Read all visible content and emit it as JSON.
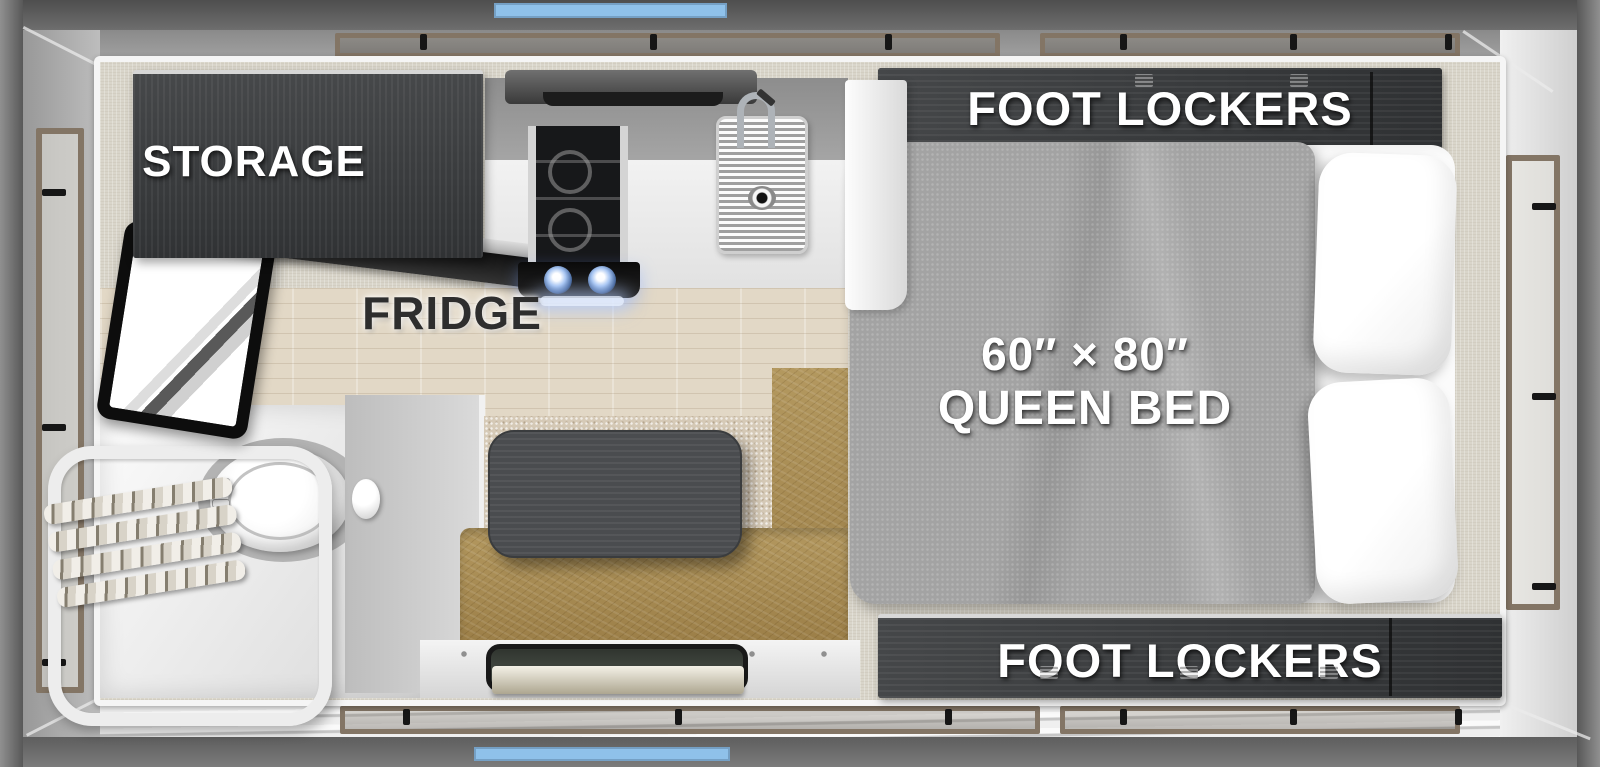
{
  "title": "Truck camper floor plan (top view)",
  "labels": {
    "storage": "STORAGE",
    "fridge": "FRIDGE",
    "bed_size": "60″ × 80″",
    "bed_type": "QUEEN BED",
    "foot_lockers": "FOOT LOCKERS"
  },
  "colors": {
    "accent_blue": "#8FC1EA",
    "cabinet_dark_wood": "#3B3D3F",
    "bench_leather_tan": "#A98C55",
    "bed_blanket_gray": "#A3A3A3",
    "window_frame_tan": "#837565",
    "floor_wood_beige": "#E2D8C6",
    "label_white": "#FFFFFF",
    "fridge_label_dark": "#2E2E2E"
  },
  "fixtures": [
    "storage-cabinet",
    "fridge",
    "tv",
    "range-hood",
    "cooktop",
    "sink-with-faucet",
    "wet-bath-shower",
    "toilet",
    "shower-caddy",
    "dinette-table",
    "dinette-bench",
    "entry-step",
    "queen-bed",
    "pillows",
    "foot-lockers-front",
    "foot-lockers-rear",
    "side-windows",
    "roof-windows"
  ]
}
